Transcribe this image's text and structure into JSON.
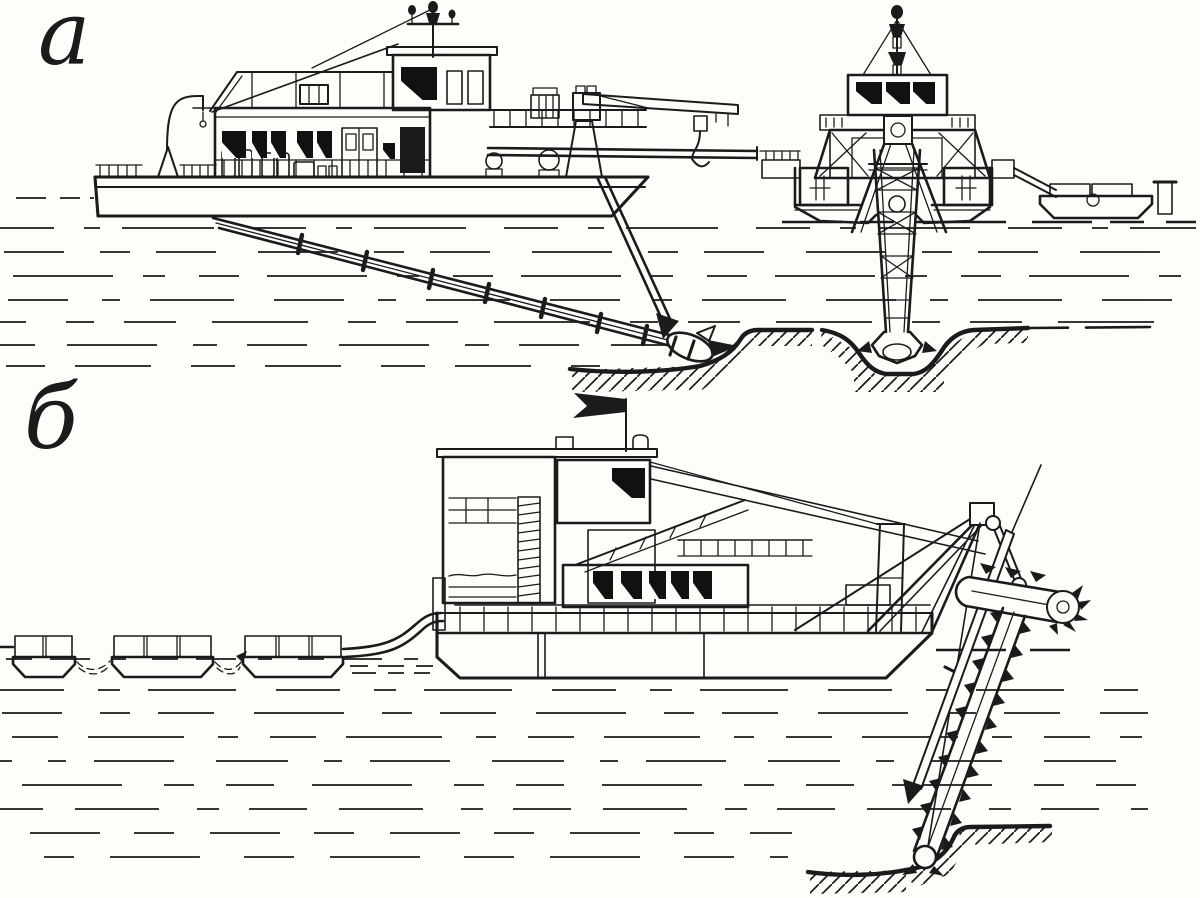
{
  "figure": {
    "paper_color": "#fdfdfa",
    "ink_color": "#1b1b1b",
    "labels": {
      "panel_a": "а",
      "panel_b": "б"
    }
  }
}
